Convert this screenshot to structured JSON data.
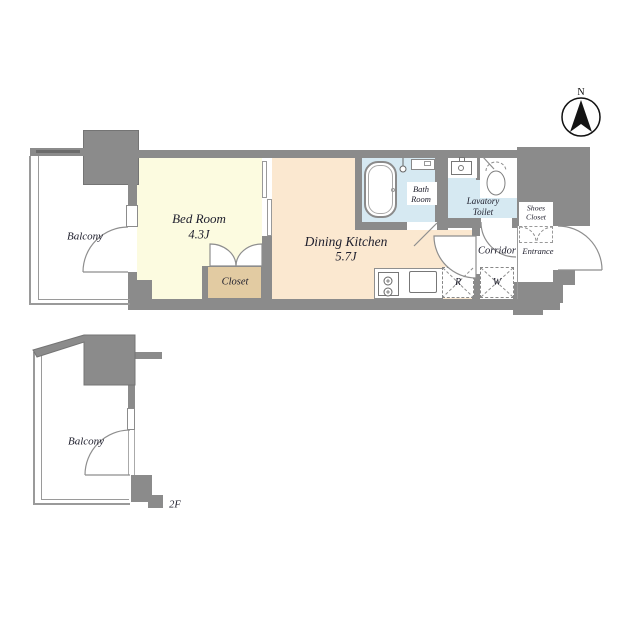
{
  "compass": {
    "north": "N"
  },
  "floor_plan": {
    "balcony": "Balcony",
    "bedroom": {
      "name": "Bed Room",
      "area": "4.3J"
    },
    "closet": "Closet",
    "dining_kitchen": {
      "name": "Dining Kitchen",
      "area": "5.7J"
    },
    "bath_room": {
      "line1": "Bath",
      "line2": "Room"
    },
    "lavatory_toilet": {
      "line1": "Lavatory",
      "line2": "Toilet"
    },
    "shoes_closet": {
      "line1": "Shoes",
      "line2": "Closet"
    },
    "entrance": "Entrance",
    "corridor": "Corridor",
    "refrigerator_mark": "R",
    "washer_mark": "W"
  },
  "floor2": {
    "balcony": "Balcony",
    "floor_label": "2F"
  },
  "colors": {
    "wall": "#8b8b8b",
    "bedroom_floor": "#fcfbe0",
    "dining_kitchen_floor": "#fbe8d0",
    "closet_floor": "#e2cba2",
    "wet_area_floor": "#d6e9f2"
  }
}
